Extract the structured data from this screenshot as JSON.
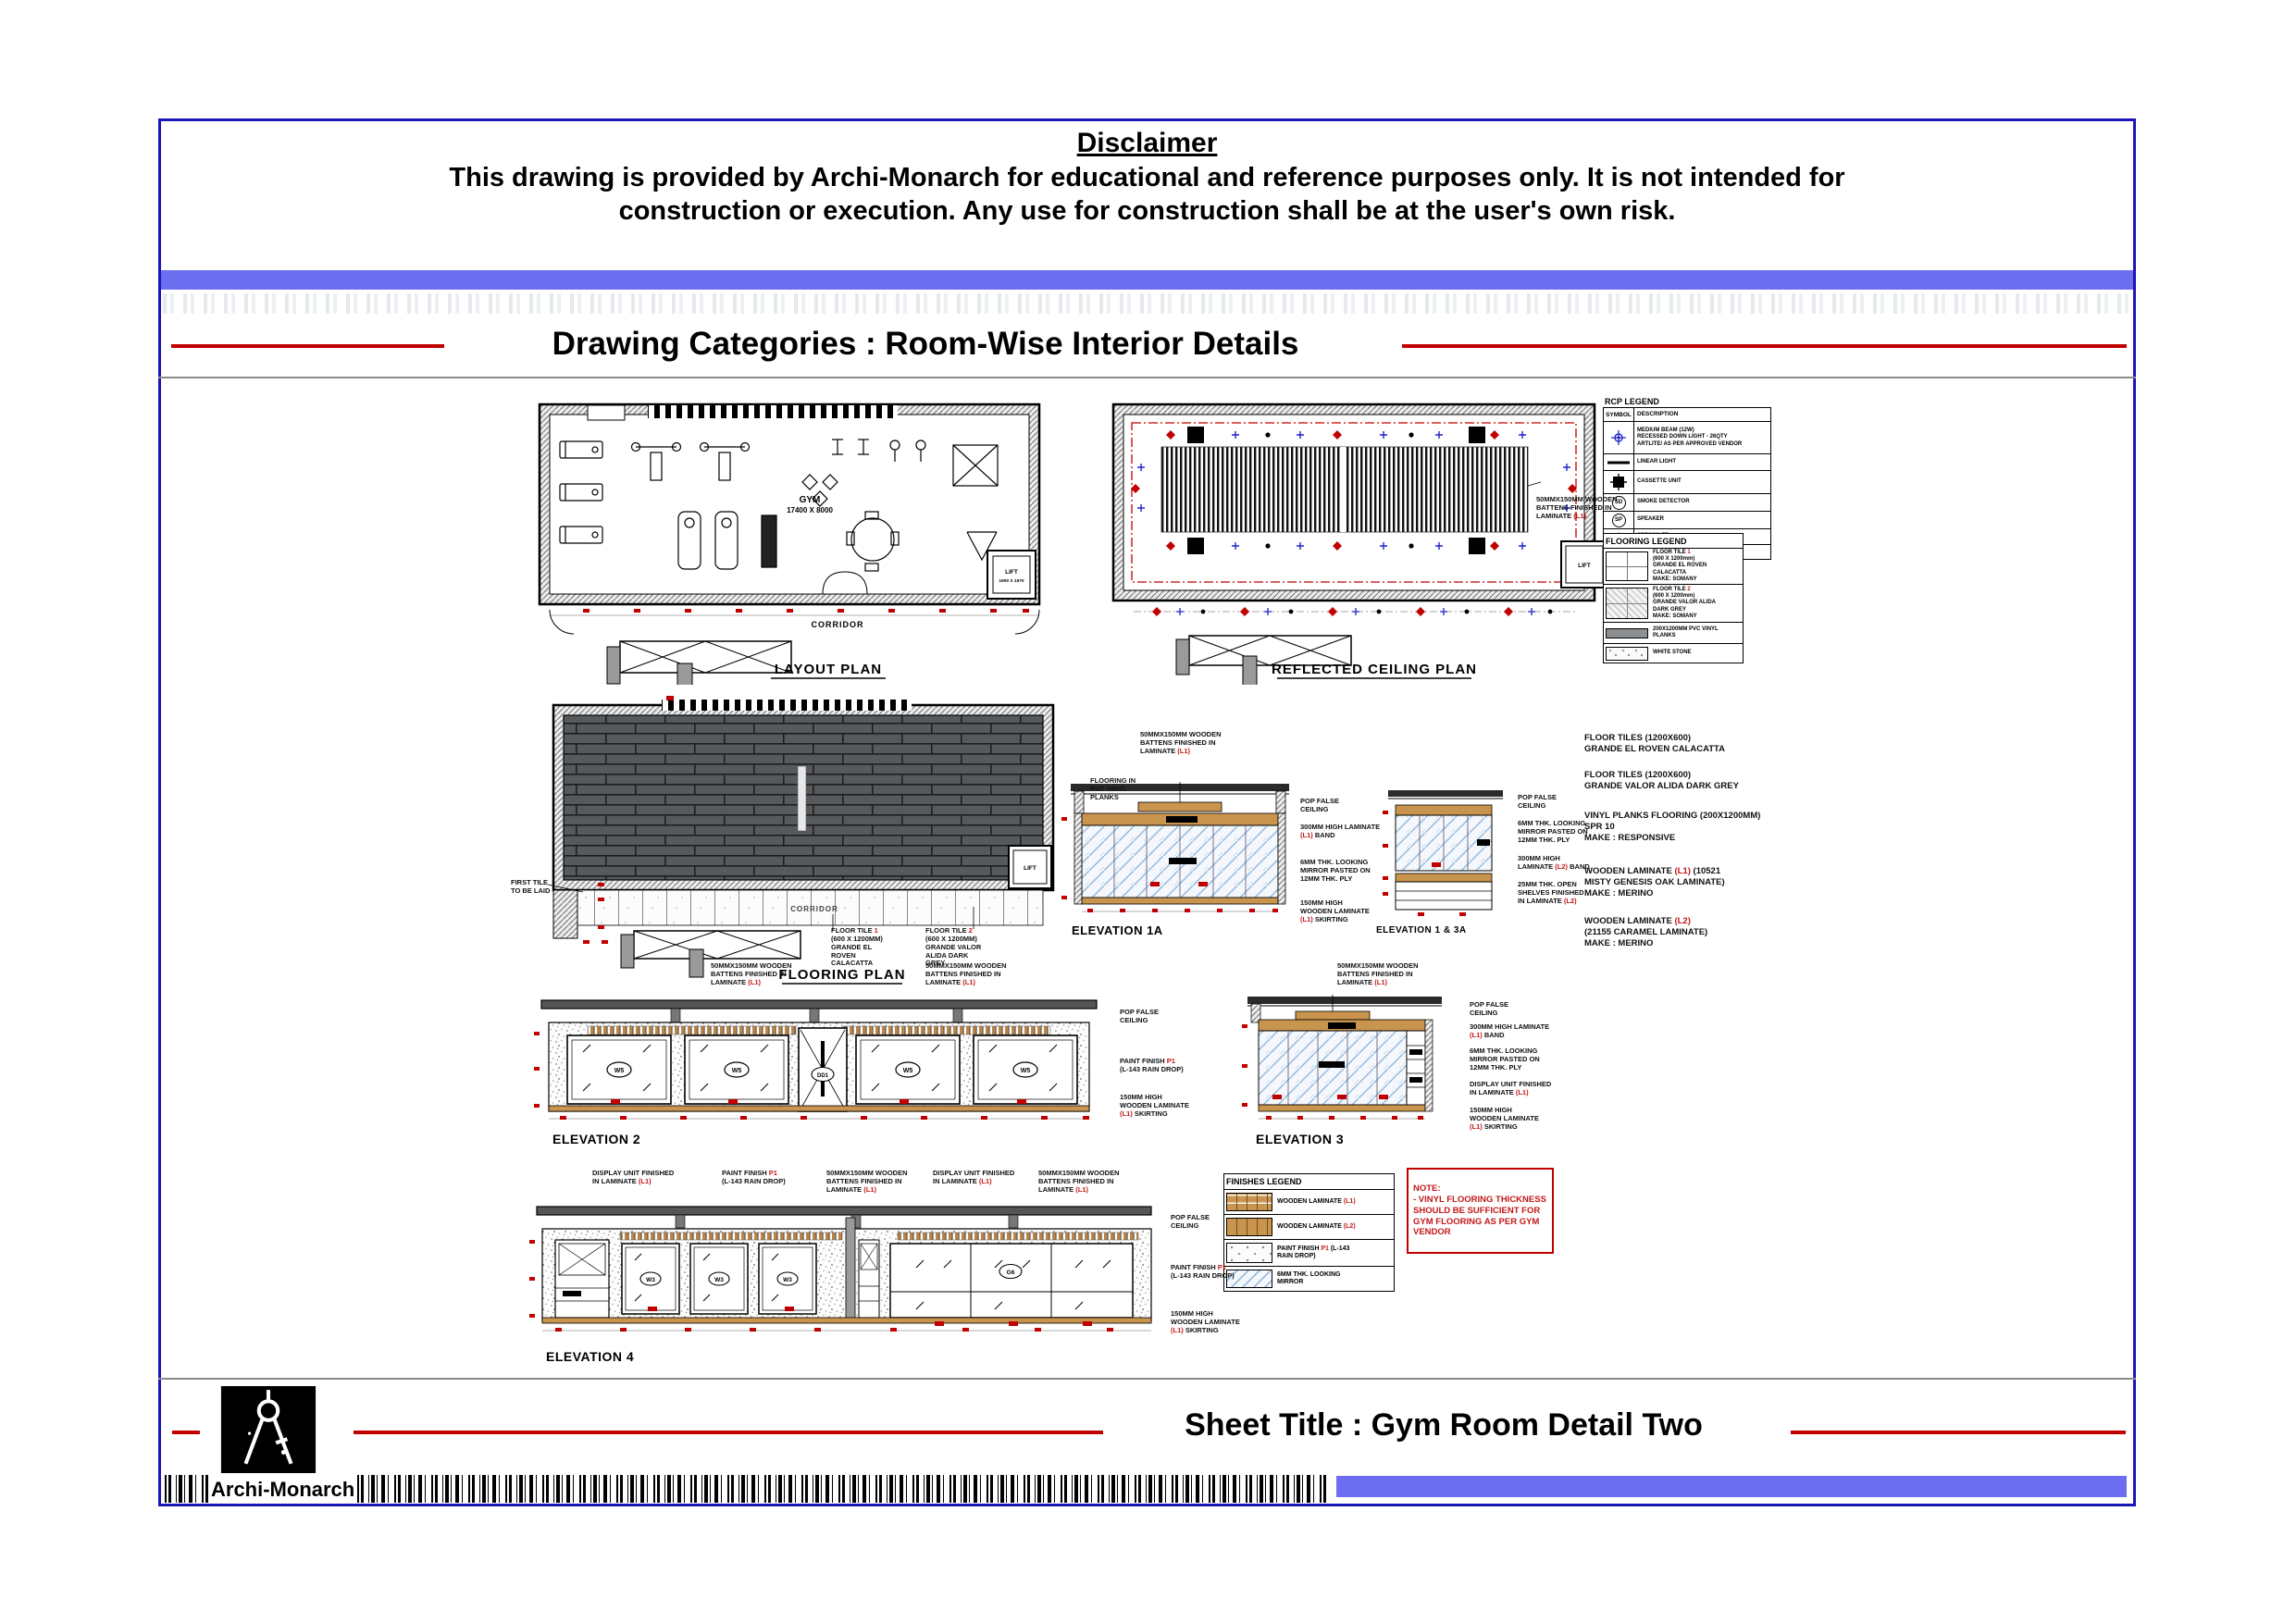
{
  "page": {
    "disclaimer_title": "Disclaimer",
    "disclaimer_line1": "This drawing is provided by Archi-Monarch for educational and reference purposes only. It is not intended for",
    "disclaimer_line2": "construction or execution. Any use for construction shall be at the user's own risk.",
    "category_title": "Drawing Categories : Room-Wise Interior Details",
    "sheet_title": "Sheet Title : Gym Room Detail Two",
    "brand": "Archi-Monarch"
  },
  "colors": {
    "border_blue": "#1b16b5",
    "bar_blue": "#6d6df2",
    "line_red": "#c00000",
    "annotation_red": "#c31818",
    "wood": "#c9944e",
    "mirror_blue": "#9cbede",
    "plank_grey": "#565a5d"
  },
  "layout_plan": {
    "title": "LAYOUT PLAN",
    "room_label_1": "GYM",
    "room_label_2": "17400 X 8000",
    "corridor_label": "CORRIDOR",
    "lift_label_1": "LIFT",
    "lift_label_2": "1900 X 1970"
  },
  "rcp": {
    "title": "REFLECTED CEILING PLAN",
    "lift_label": "LIFT",
    "batten_annotation": {
      "pre": "50MMX150MM WOODEN\nBATTENS FINISHED IN\nLAMINATE ",
      "red": "(L1)",
      "post": ""
    }
  },
  "flooring_plan": {
    "title": "FLOORING PLAN",
    "corridor_label": "CORRIDOR",
    "lift_label": "LIFT",
    "first_tile_note": {
      "pre": "FIRST TILE\nTO BE LAID",
      "red": "",
      "post": ""
    },
    "tile1_note": {
      "pre": "FLOOR TILE ",
      "red": "1",
      "post": "\n(600 X 1200MM)\nGRANDE EL\nROVEN\nCALACATTA"
    },
    "tile2_note": {
      "pre": "FLOOR TILE ",
      "red": "2",
      "post": "\n(600 X 1200MM)\nGRANDE VALOR\nALIDA DARK\nGREY"
    }
  },
  "rcp_legend": {
    "title": "RCP LEGEND",
    "col_symbol": "SYMBOL",
    "col_desc": "DESCRIPTION",
    "rows": [
      {
        "desc": "MEDIUM BEAM (12W)\nRECESSED DOWN LIGHT - 26QTY\nARTLITE/ AS PER APPROVED VENDOR"
      },
      {
        "desc": "LINEAR LIGHT"
      },
      {
        "desc": "CASSETTE UNIT"
      },
      {
        "sym": "SD",
        "desc": "SMOKE DETECTOR"
      },
      {
        "sym": "SP",
        "desc": "SPEAKER"
      },
      {
        "desc": "SPRINKLER"
      },
      {
        "desc": "COVE LIGHT"
      }
    ]
  },
  "flooring_legend": {
    "title": "FLOORING LEGEND",
    "rows": [
      {
        "pre": "FLOOR TILE ",
        "red": "1",
        "post": "\n(600 X 1200mm)\nGRANDE EL ROVEN\nCALACATTA\nMAKE: SOMANY"
      },
      {
        "pre": "FLOOR TILE ",
        "red": "2",
        "post": "\n(600 X 1200mm)\nGRANDE VALOR ALIDA\nDARK GREY\nMAKE: SOMANY"
      },
      {
        "pre": "200X1200MM PVC VINYL\nPLANKS",
        "red": "",
        "post": ""
      },
      {
        "pre": "WHITE STONE",
        "red": "",
        "post": ""
      }
    ]
  },
  "materials_notes": [
    {
      "pre": "FLOOR TILES (1200X600)\nGRANDE EL ROVEN CALACATTA",
      "red": "",
      "post": ""
    },
    {
      "pre": "FLOOR TILES (1200X600)\nGRANDE VALOR ALIDA DARK GREY",
      "red": "",
      "post": ""
    },
    {
      "pre": "VINYL PLANKS FLOORING (200X1200MM)\nSPR 10\nMAKE : RESPONSIVE",
      "red": "",
      "post": ""
    },
    {
      "pre": "WOODEN LAMINATE ",
      "red": "(L1)",
      "post": " (10521\nMISTY GENESIS OAK LAMINATE)\nMAKE : MERINO"
    },
    {
      "pre": "WOODEN LAMINATE ",
      "red": "(L2)",
      "post": "\n(21155 CARAMEL LAMINATE)\nMAKE : MERINO"
    }
  ],
  "finishes_legend": {
    "title": "FINISHES LEGEND",
    "rows": [
      {
        "pre": "WOODEN LAMINATE ",
        "red": "(L1)",
        "post": ""
      },
      {
        "pre": "WOODEN LAMINATE ",
        "red": "(L2)",
        "post": ""
      },
      {
        "pre": "PAINT FINISH ",
        "red": "P1",
        "post": " (L-143\nRAIN DROP)"
      },
      {
        "pre": "6MM THK. LOOKING\nMIRROR",
        "red": "",
        "post": ""
      }
    ]
  },
  "note_box": {
    "title": "NOTE:",
    "body": "- VINYL FLOORING THICKNESS\nSHOULD BE SUFFICIENT FOR\nGYM FLOORING AS PER GYM\nVENDOR"
  },
  "elevations": {
    "e1a": {
      "title": "ELEVATION 1A",
      "battens": {
        "pre": "50MMX150MM WOODEN\nBATTENS FINISHED IN\nLAMINATE ",
        "red": "(L1)",
        "post": ""
      },
      "pop": {
        "pre": "POP FALSE\nCEILING",
        "red": "",
        "post": ""
      },
      "band": {
        "pre": "300MM HIGH LAMINATE\n",
        "red": "(L1)",
        "post": " BAND"
      },
      "mirror": {
        "pre": "6MM THK. LOOKING\nMIRROR PASTED ON\n12MM THK. PLY",
        "red": "",
        "post": ""
      },
      "skirting": {
        "pre": "150MM HIGH\nWOODEN LAMINATE\n",
        "red": "(L1)",
        "post": " SKIRTING"
      }
    },
    "e13a": {
      "title": "ELEVATION 1 & 3A",
      "pop": {
        "pre": "POP FALSE\nCEILING",
        "red": "",
        "post": ""
      },
      "mirror": {
        "pre": "6MM THK. LOOKING\nMIRROR PASTED ON\n12MM THK. PLY",
        "red": "",
        "post": ""
      },
      "band": {
        "pre": "300MM HIGH\nLAMINATE ",
        "red": "(L2)",
        "post": " BAND"
      },
      "shelves": {
        "pre": "25MM THK. OPEN\nSHELVES FINISHED\nIN LAMINATE ",
        "red": "(L2)",
        "post": ""
      }
    },
    "e2": {
      "title": "ELEVATION 2",
      "battens_left": {
        "pre": "50MMX150MM WOODEN\nBATTENS FINISHED IN\nLAMINATE ",
        "red": "(L1)",
        "post": ""
      },
      "battens_right": {
        "pre": "50MMX150MM WOODEN\nBATTENS FINISHED IN\nLAMINATE ",
        "red": "(L1)",
        "post": ""
      },
      "pop": {
        "pre": "POP FALSE\nCEILING",
        "red": "",
        "post": ""
      },
      "paint": {
        "pre": "PAINT FINISH ",
        "red": "P1",
        "post": "\n(L-143 RAIN DROP)"
      },
      "skirting": {
        "pre": "150MM HIGH\nWOODEN LAMINATE\n",
        "red": "(L1)",
        "post": " SKIRTING"
      },
      "window_label": "W5",
      "door_label": "DD1"
    },
    "e3": {
      "title": "ELEVATION 3",
      "battens": {
        "pre": "50MMX150MM WOODEN\nBATTENS FINISHED IN\nLAMINATE ",
        "red": "(L1)",
        "post": ""
      },
      "pop": {
        "pre": "POP FALSE\nCEILING",
        "red": "",
        "post": ""
      },
      "band": {
        "pre": "300MM HIGH LAMINATE\n",
        "red": "(L1)",
        "post": " BAND"
      },
      "mirror": {
        "pre": "6MM THK. LOOKING\nMIRROR PASTED ON\n12MM THK. PLY",
        "red": "",
        "post": ""
      },
      "display": {
        "pre": "DISPLAY UNIT FINISHED\nIN LAMINATE ",
        "red": "(L1)",
        "post": ""
      },
      "skirting": {
        "pre": "150MM HIGH\nWOODEN LAMINATE\n",
        "red": "(L1)",
        "post": " SKIRTING"
      }
    },
    "e4": {
      "title": "ELEVATION 4",
      "display_left": {
        "pre": "DISPLAY UNIT FINISHED\nIN LAMINATE ",
        "red": "(L1)",
        "post": ""
      },
      "paint_top": {
        "pre": "PAINT FINISH ",
        "red": "P1",
        "post": "\n(L-143 RAIN DROP)"
      },
      "battens_mid": {
        "pre": "50MMX150MM WOODEN\nBATTENS FINISHED IN\nLAMINATE ",
        "red": "(L1)",
        "post": ""
      },
      "display_right": {
        "pre": "DISPLAY UNIT FINISHED\nIN LAMINATE ",
        "red": "(L1)",
        "post": ""
      },
      "battens_right": {
        "pre": "50MMX150MM WOODEN\nBATTENS FINISHED IN\nLAMINATE ",
        "red": "(L1)",
        "post": ""
      },
      "pop": {
        "pre": "POP FALSE\nCEILING",
        "red": "",
        "post": ""
      },
      "paint_right": {
        "pre": "PAINT FINISH ",
        "red": "P1",
        "post": "\n(L-143 RAIN DROP)"
      },
      "skirting": {
        "pre": "150MM HIGH\nWOODEN LAMINATE\n",
        "red": "(L1)",
        "post": " SKIRTING"
      },
      "window_label": "W3",
      "glazing_label": "G6"
    }
  },
  "flooring_side_note": {
    "pre": "FLOORING IN\nPVC VINYL\nPLANKS",
    "red": "",
    "post": ""
  }
}
